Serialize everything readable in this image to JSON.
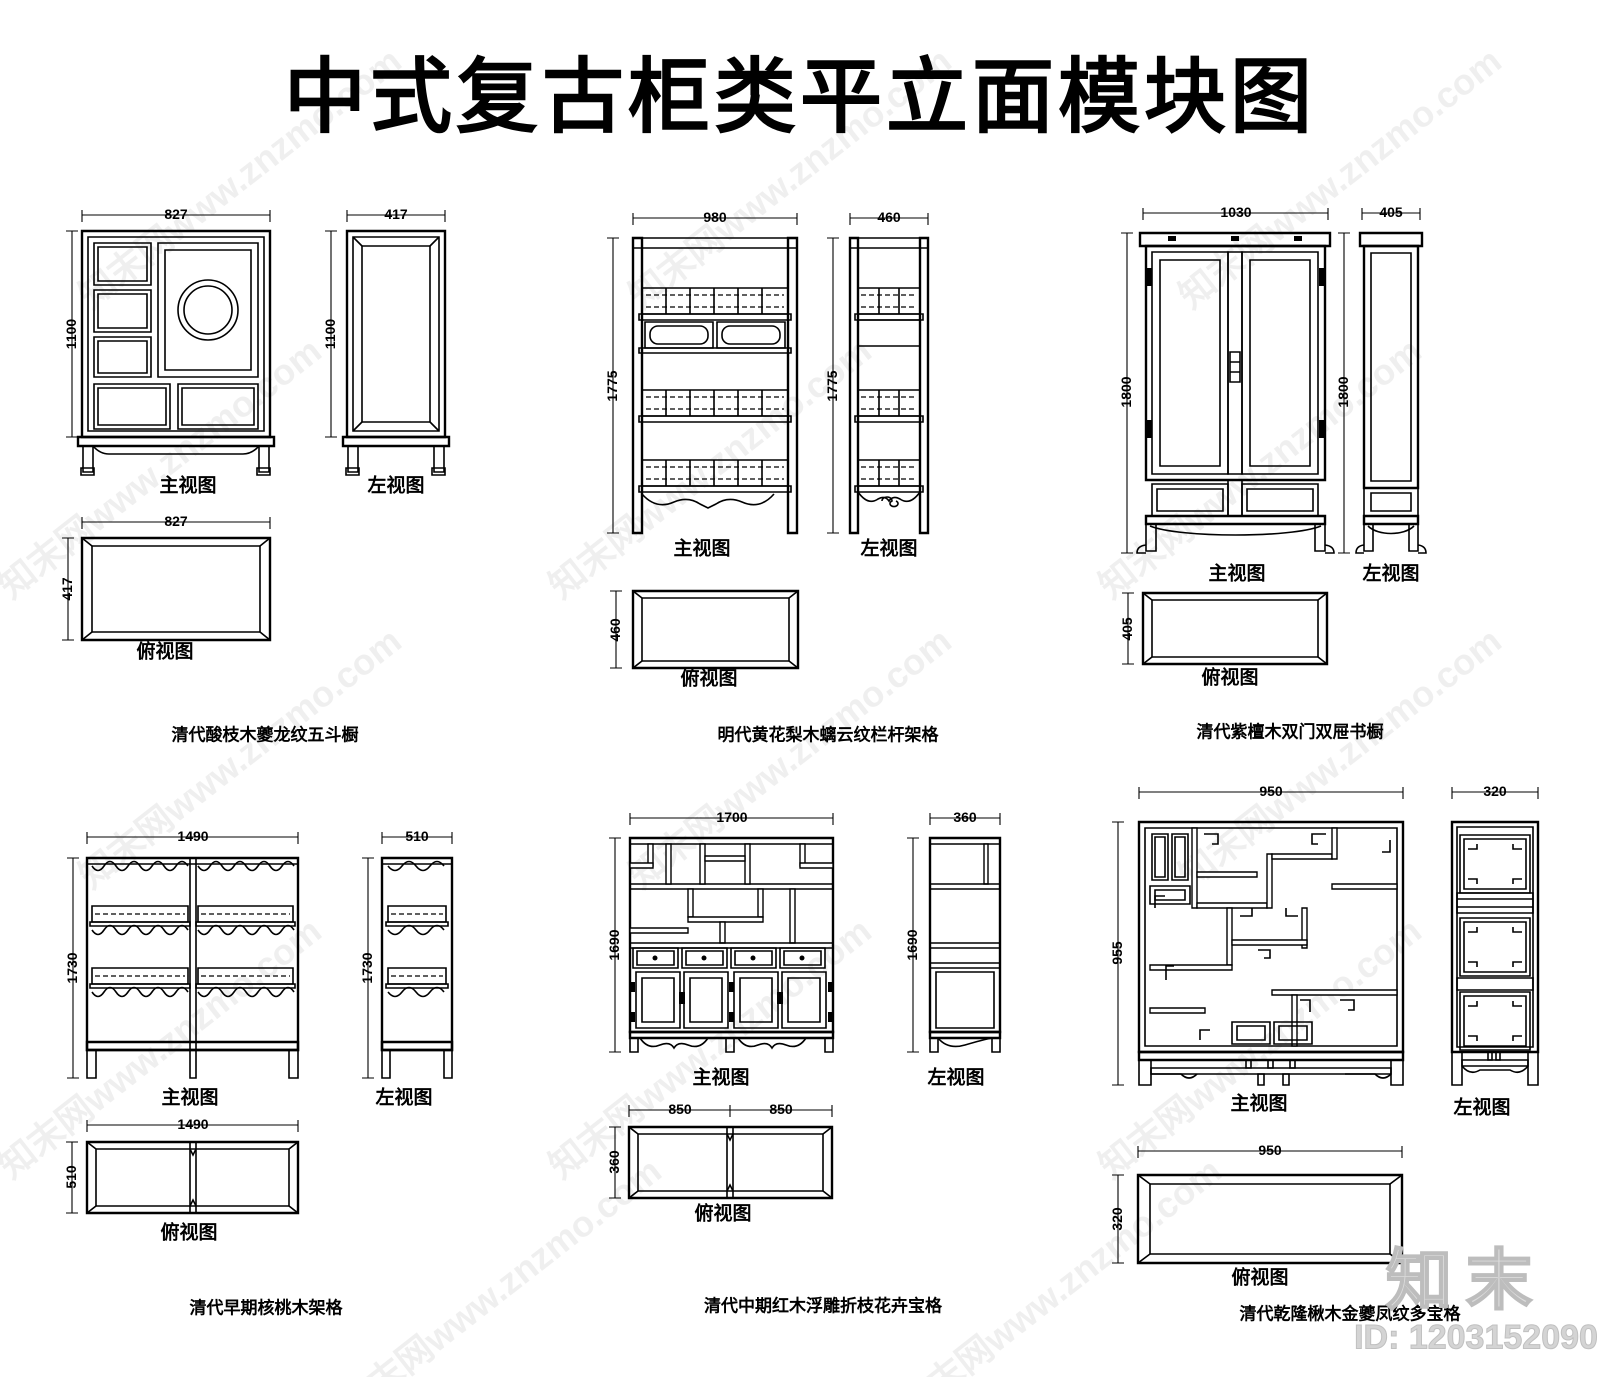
{
  "page_title": "中式复古柜类平立面模块图",
  "view_labels": {
    "front": "主视图",
    "side": "左视图",
    "plan": "俯视图"
  },
  "watermark": {
    "tile_text": "知末网www.znzmo.com",
    "logo_text": "知末",
    "id_text": "ID: 1203152090"
  },
  "items": [
    {
      "caption": "清代酸枝木夔龙纹五斗橱",
      "dims": {
        "front_w": "827",
        "front_h": "1100",
        "side_w": "417",
        "side_h": "1100",
        "plan_w": "827",
        "plan_h": "417"
      }
    },
    {
      "caption": "明代黄花梨木螭云纹栏杆架格",
      "dims": {
        "front_w": "980",
        "front_h": "1775",
        "side_w": "460",
        "side_h": "1775",
        "plan_h": "460"
      }
    },
    {
      "caption": "清代紫檀木双门双屉书橱",
      "dims": {
        "front_w": "1030",
        "front_h": "1800",
        "side_w": "405",
        "side_h": "1800",
        "plan_h": "405"
      }
    },
    {
      "caption": "清代早期核桃木架格",
      "dims": {
        "front_w": "1490",
        "front_h": "1730",
        "side_w": "510",
        "side_h": "1730",
        "plan_w": "1490",
        "plan_h": "510"
      }
    },
    {
      "caption": "清代中期红木浮雕折枝花卉宝格",
      "dims": {
        "front_w": "1700",
        "front_h": "1690",
        "side_w": "360",
        "side_h": "1690",
        "plan_w1": "850",
        "plan_w2": "850",
        "plan_h": "360"
      }
    },
    {
      "caption": "清代乾隆楸木金夔凤纹多宝格",
      "dims": {
        "front_w": "950",
        "front_h": "955",
        "side_w": "320",
        "plan_w": "950",
        "plan_h": "320"
      }
    }
  ]
}
